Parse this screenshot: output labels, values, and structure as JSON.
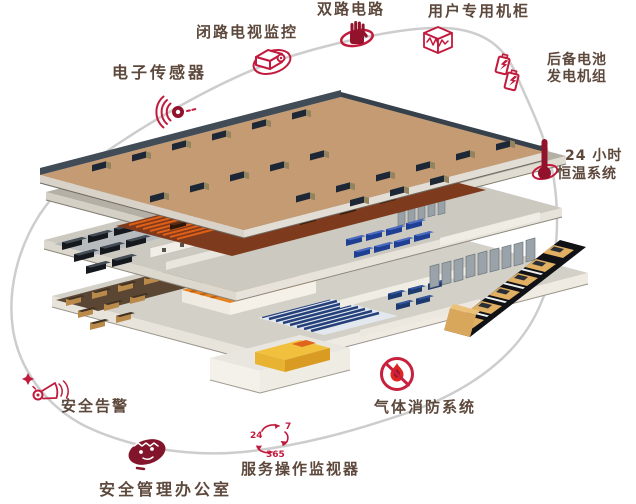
{
  "diagram": {
    "type": "isometric-datacenter-cutaway",
    "callouts": [
      {
        "id": "cctv",
        "icon": "cctv-camera-icon",
        "label": "闭路电视监控"
      },
      {
        "id": "sensor",
        "icon": "electronic-sensor-icon",
        "label": "电子传感器"
      },
      {
        "id": "dual-power",
        "icon": "hand-icon",
        "label": "双路电路"
      },
      {
        "id": "cabinet",
        "icon": "rack-cabinet-icon",
        "label": "用户专用机柜"
      },
      {
        "id": "backup-power",
        "icon": "battery-icon",
        "label1": "后备电池",
        "label2": "发电机组"
      },
      {
        "id": "temperature",
        "icon": "thermometer-icon",
        "label1": "24 小时",
        "label2": "恒温系统"
      },
      {
        "id": "fire",
        "icon": "no-fire-icon",
        "label": "气体消防系统"
      },
      {
        "id": "monitor",
        "icon": "cycle-24-7-365-icon",
        "label": "服务操作监视器",
        "numbers": {
          "n24": "24",
          "n7": "7",
          "n365": "365"
        }
      },
      {
        "id": "office",
        "icon": "security-guard-icon",
        "label": "安全管理办公室"
      },
      {
        "id": "alarm",
        "icon": "siren-icon",
        "label": "安全告警"
      }
    ],
    "colors": {
      "accent": "#c11a3c",
      "solid_icon": "#93122b",
      "label_text": "#5d483c",
      "orbit": "#cdcdcd",
      "roof_tan": "#c49b73",
      "copper_floor": "#7e3a1c",
      "grid_orange": "#e05f16"
    }
  }
}
